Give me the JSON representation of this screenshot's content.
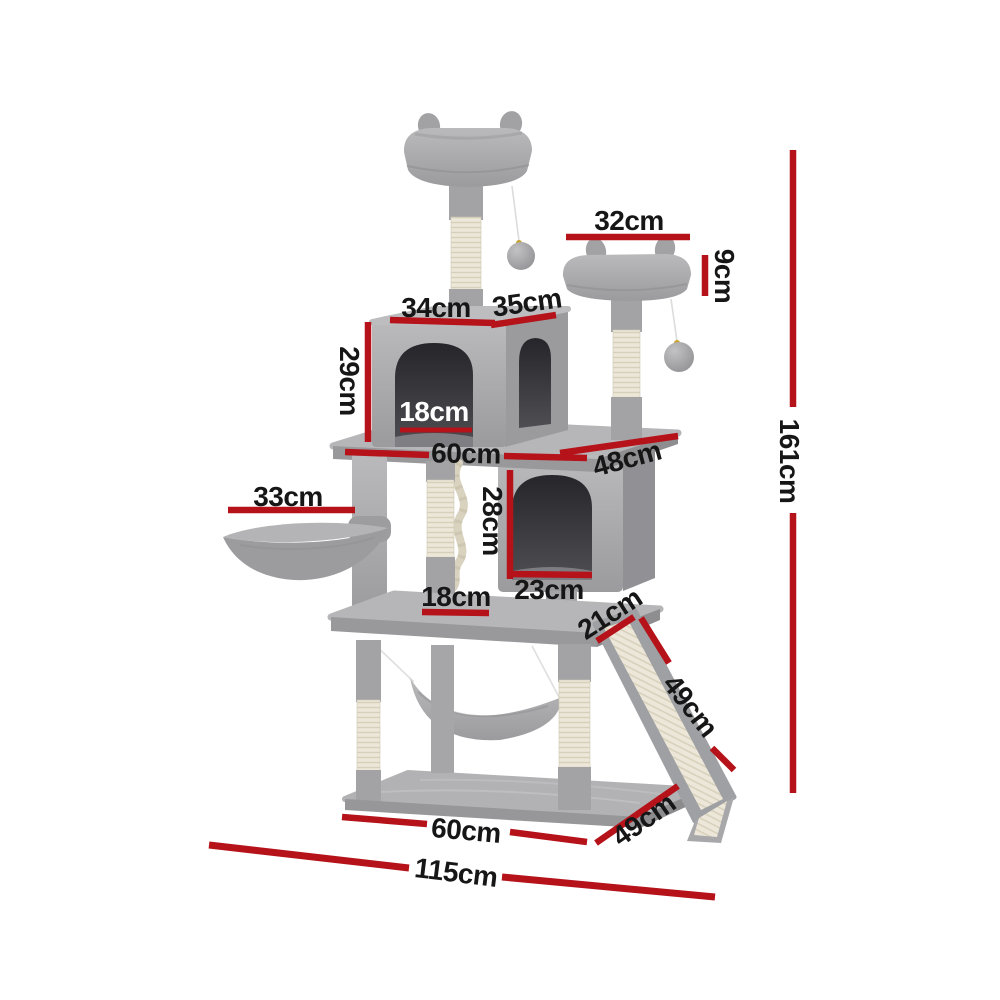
{
  "figure": {
    "type": "product dimension diagram",
    "subject": "cat tree tower with scratching posts, two condos, two perches, basket, hammock and sisal ramp",
    "background_color": "#ffffff",
    "dimension_line_color": "#b5121a",
    "label_color": "#161616",
    "label_color_on_dark": "#ffffff",
    "plush_color": "#a8a8ab",
    "sisal_color": "#ece7d9"
  },
  "dimensions": {
    "second_perch_width": {
      "label": "32cm"
    },
    "second_perch_height": {
      "label": "9cm"
    },
    "upper_condo_roof_width": {
      "label": "34cm"
    },
    "upper_condo_roof_depth": {
      "label": "35cm"
    },
    "upper_condo_height": {
      "label": "29cm"
    },
    "upper_condo_door_width": {
      "label": "18cm"
    },
    "middle_platform_width": {
      "label": "60cm"
    },
    "middle_platform_depth": {
      "label": "48cm"
    },
    "lower_condo_height": {
      "label": "28cm"
    },
    "basket_width": {
      "label": "33cm"
    },
    "lower_condo_door_width": {
      "label": "23cm"
    },
    "lower_ledge_width": {
      "label": "18cm"
    },
    "ramp_width": {
      "label": "21cm"
    },
    "ramp_length": {
      "label": "49cm"
    },
    "base_width": {
      "label": "60cm"
    },
    "base_depth": {
      "label": "49cm"
    },
    "overall_width": {
      "label": "115cm"
    },
    "overall_height": {
      "label": "161cm"
    }
  }
}
